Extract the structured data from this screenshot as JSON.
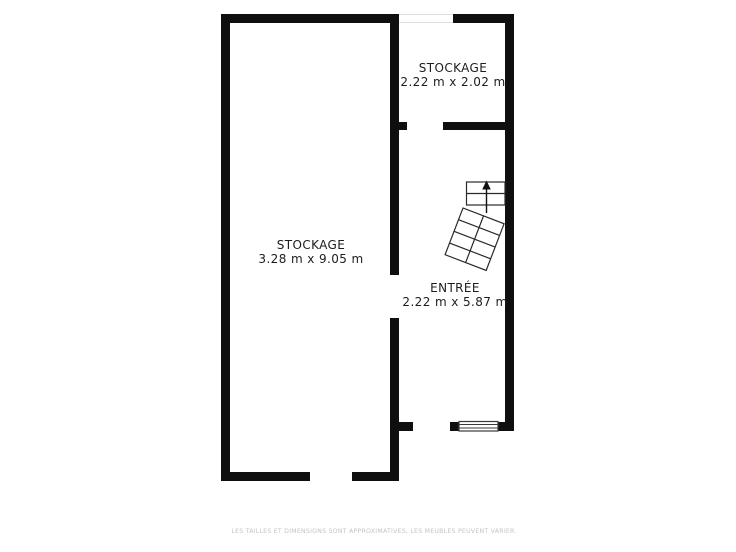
{
  "plan": {
    "title": "floor-plan",
    "rooms": [
      {
        "id": "storage-large",
        "name": "STOCKAGE",
        "dimensions": "3.28 m x 9.05 m"
      },
      {
        "id": "storage-small",
        "name": "STOCKAGE",
        "dimensions": "2.22 m x 2.02 m"
      },
      {
        "id": "entrance",
        "name": "ENTRÉE",
        "dimensions": "2.22 m x 5.87 m"
      }
    ],
    "disclaimer": "LES TAILLES ET DIMENSIONS SONT APPROXIMATIVES, LES MEUBLES PEUVENT VARIER.",
    "icons": {
      "stairs": "winder-staircase-with-up-arrow",
      "window": "double-line-window-symbol"
    },
    "colors": {
      "wall": "#0f0f0f",
      "stair_line": "#2a2a2a",
      "text": "#1d1d1d",
      "disclaimer_text": "#c3c3c3",
      "background": "#ffffff"
    }
  }
}
